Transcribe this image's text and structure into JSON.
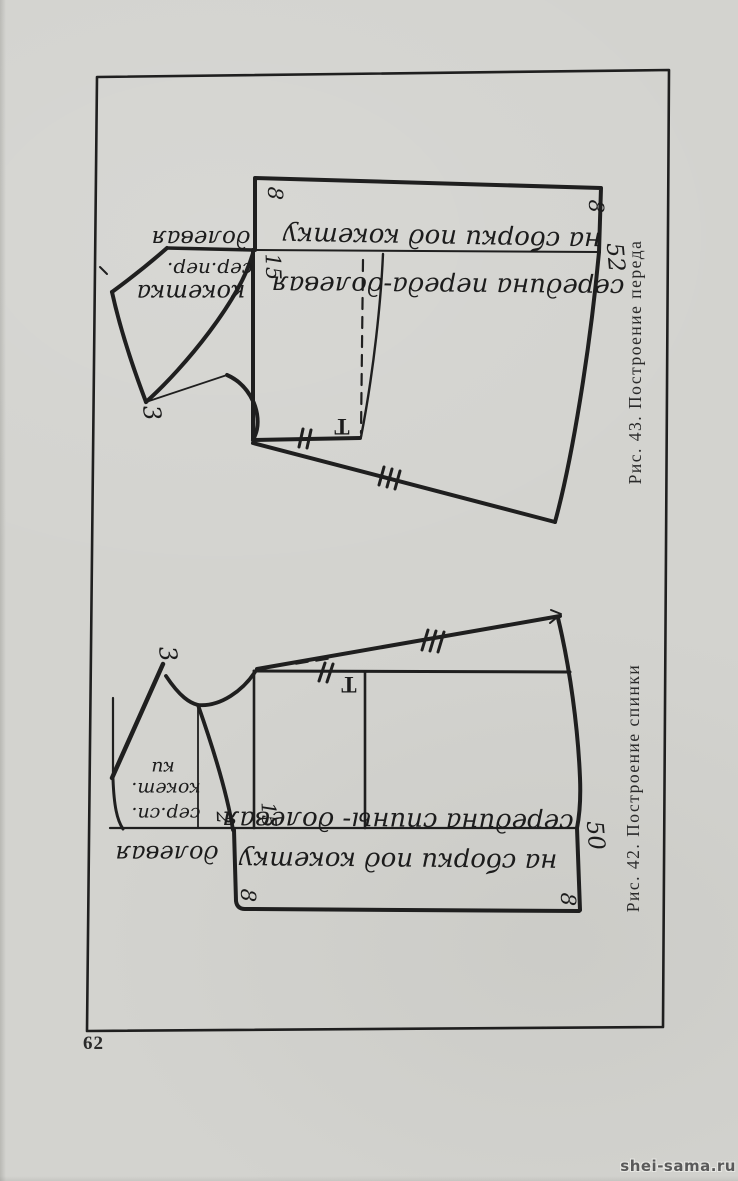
{
  "page": {
    "number": "62",
    "watermark": "shei-sama.ru"
  },
  "palette": {
    "paper": "#d3d3cf",
    "ink": "#1f1f1f",
    "watermark_color": "#5a5a5a"
  },
  "figures": {
    "front": {
      "caption": "Рис. 43. Построение переда",
      "band_label": "на сборки под кокетку",
      "center_label": "середина переда-долевая",
      "grain_label": "долевая",
      "yoke_label_line1": "кокетка",
      "yoke_label_line2": "сер.пер.",
      "dim_8_left": "8",
      "dim_8_right": "8",
      "dim_15": "15",
      "dim_52": "52",
      "dim_3": "3",
      "point_t": "T"
    },
    "back": {
      "caption": "Рис. 42. Построение спинки",
      "band_label": "на сборки под кокетку",
      "center_label": "середина спины- долевая",
      "grain_label": "долевая",
      "yoke_label_line1": "сер.сп.",
      "yoke_label_line2": "кокет.",
      "yoke_label_line3": "ки",
      "dim_8_left": "8",
      "dim_8_right": "8",
      "dim_15": "15",
      "dim_50": "50",
      "dim_2": "2",
      "dim_3": "3",
      "point_t": "T"
    }
  }
}
